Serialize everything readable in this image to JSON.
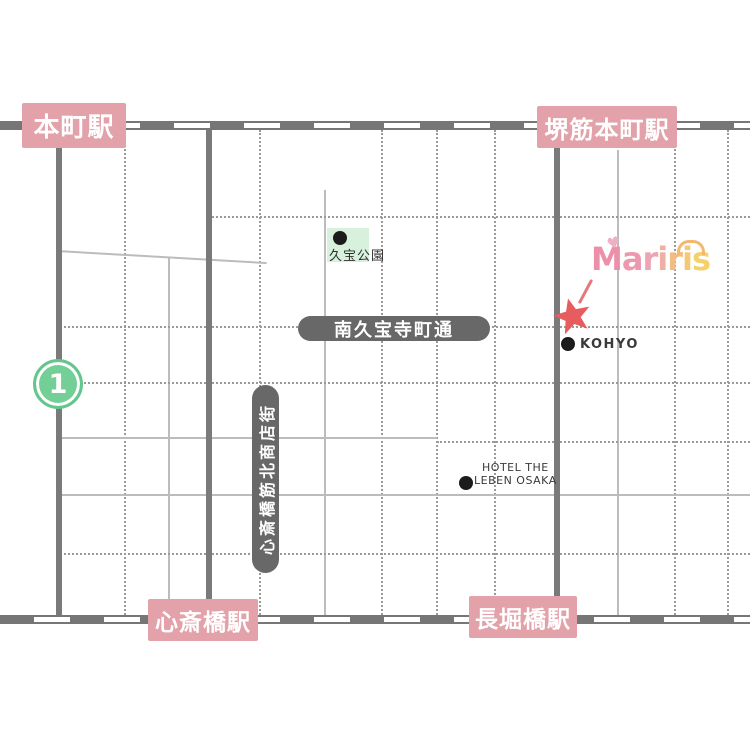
{
  "stations": [
    {
      "label": "本町駅"
    },
    {
      "label": "堺筋本町駅"
    },
    {
      "label": "心斎橋駅"
    },
    {
      "label": "長堀橋駅"
    }
  ],
  "streets": {
    "minami_kyuhoji": {
      "label": "南久宝寺町通"
    },
    "shinsaibashi_suji_kita": {
      "label": "心斎橋筋北商店街"
    }
  },
  "pois": {
    "park": {
      "label": "久宝公園"
    },
    "kohyo": {
      "label": "KOHYO"
    },
    "hotel": {
      "line1": "HOTEL THE",
      "line2": "LEBEN OSAKA"
    }
  },
  "exit_badge": {
    "number": "1"
  },
  "logo": {
    "text": "Mariris",
    "letters": [
      {
        "ch": "M",
        "color": "#ec8fa9"
      },
      {
        "ch": "a",
        "color": "#ec99af"
      },
      {
        "ch": "r",
        "color": "#eda4b3"
      },
      {
        "ch": "i",
        "color": "#efb0a4"
      },
      {
        "ch": "r",
        "color": "#f2bd85"
      },
      {
        "ch": "i",
        "color": "#f4c974"
      },
      {
        "ch": "s",
        "color": "#f5d16c"
      }
    ],
    "heart_icon": "♥",
    "heart_color": "#f2aec2",
    "arc_color": "#f3b86e"
  },
  "marker": {
    "star_color": "#e65c5f",
    "stick_color": "#e4787f"
  },
  "colors": {
    "station_label_bg": "#e3a1aa",
    "station_label_text": "#ffffff",
    "road_gray": "#7a7a7a",
    "railway_gray": "#767676",
    "street_pill_bg": "#686868",
    "park_bg": "#d8f1dd",
    "exit_badge_green": "#74cf97",
    "poi_text": "#3a3a3a",
    "grid_solid": "#bcbcbc",
    "grid_dotted": "#9a9a9a",
    "background": "#ffffff"
  }
}
